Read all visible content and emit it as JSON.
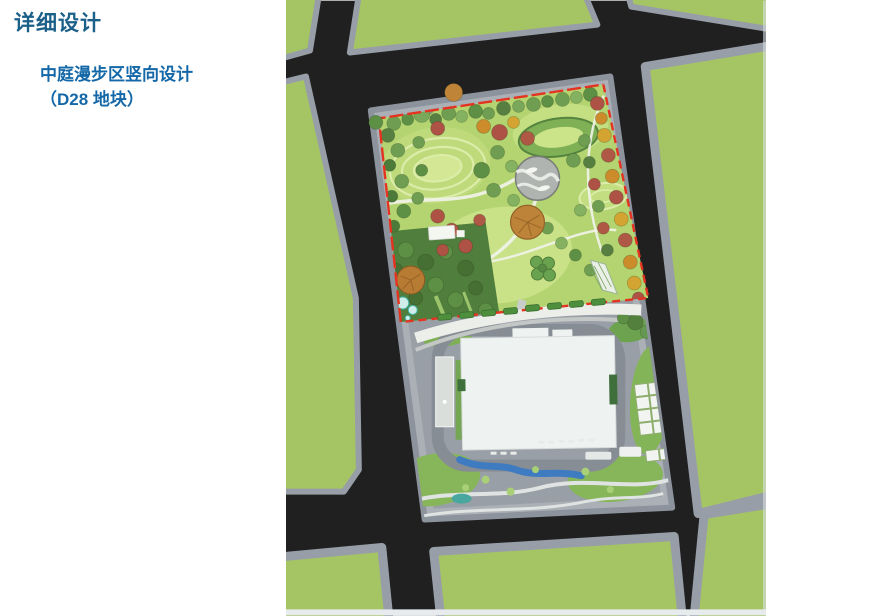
{
  "slide": {
    "title": "详细设计",
    "subtitle_line1": "中庭漫步区竖向设计",
    "subtitle_line2": "（D28 地块）"
  },
  "map": {
    "kind": "aerial site plan rendering",
    "features": [
      "city-roads",
      "sidewalks",
      "green-parcels",
      "courtyard-park",
      "red-plot-boundary",
      "hill-contours",
      "circular-plaza",
      "trees",
      "greenhouse",
      "clover-planting",
      "main-building",
      "annex-building",
      "loop-road",
      "water-channel",
      "sports-courts",
      "parking-ticks",
      "pond"
    ]
  },
  "colors": {
    "title_blue": "#1B6089",
    "subtitle_blue": "#1568A8",
    "road_dark": "#1F201F",
    "sidewalk_gray": "#989EA8",
    "ring_gray": "#AAB0B6",
    "parcel_green": "#A5C564",
    "lawn_green": "#B3D470",
    "plaza_gray": "#999FA6",
    "boundary_red": "#E53322",
    "building_white": "#EEF3F1",
    "water_blue": "#3E7BC0"
  }
}
